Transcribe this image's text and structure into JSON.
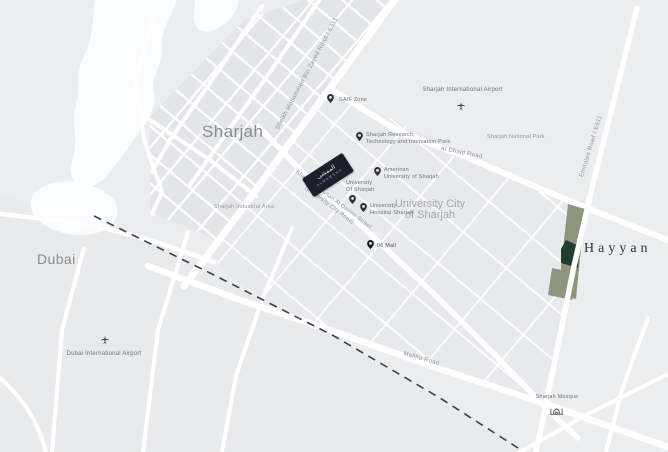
{
  "map": {
    "cities": {
      "sharjah": "Sharjah",
      "dubai": "Dubai"
    },
    "areas": {
      "university_city": {
        "line1": "University City",
        "line2": "of Sharjah"
      },
      "industrial_area": "Sharjah Industrial Area",
      "national_park": "Sharjah National Park"
    },
    "pois": {
      "saif_zone": "SAIF Zone",
      "sharjah_airport": "Sharjah International Airport",
      "dubai_airport": "Dubai International Airport",
      "research_park": {
        "line1": "Sharjah Research,",
        "line2": "Technology and Innovation Park"
      },
      "american_university": {
        "line1": "American",
        "line2": "University of Sharjah"
      },
      "university_of_sharjah": {
        "line1": "University",
        "line2": "Of Sharjah"
      },
      "university_hospital": {
        "line1": "University",
        "line2": "Hospital Sharjah"
      },
      "mall": "06 Mall",
      "mosque": "Sharjah Mosque"
    },
    "roads": {
      "smbz": "Sheikh Mohammed Bin Zayed Road / E311",
      "emirates": "Emirates Road / E611",
      "al_dhaid": "Al Dhaid Road",
      "maliha": "Maliha Road",
      "khalid": {
        "line1": "Khalid Bin Sultan Al Qasimi Street",
        "line2": "(University City Road)"
      }
    },
    "development": {
      "name": "Hayyan",
      "badge": {
        "line1": "الممشى",
        "line2": "ALMAMSHA"
      }
    },
    "colors": {
      "land": "#ecedef",
      "dubai_land": "#e9eaec",
      "city_blocks": "#e3e5e8",
      "big_blocks": "#e7e9ec",
      "water": "#fbfcfe",
      "road": "#ffffff",
      "border_dash": "#3a3f49",
      "plot_sage": "#8e957e",
      "plot_dark": "#1f3e2e",
      "badge_bg": "#1b212c",
      "poi_label": "#6c717b",
      "city_label": "#878c95"
    }
  }
}
